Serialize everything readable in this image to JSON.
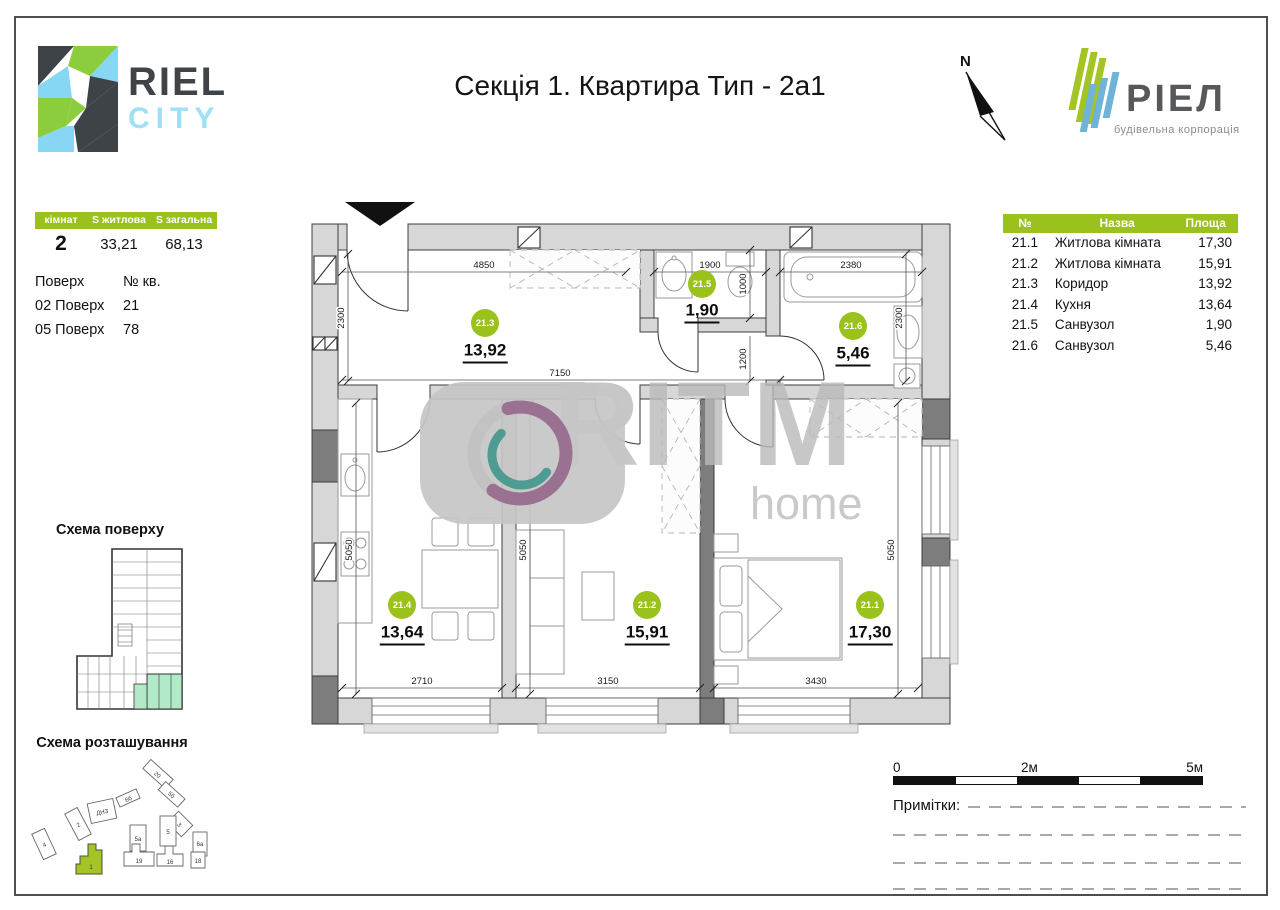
{
  "colors": {
    "accent": "#9bc11d",
    "mint": "#b2e9c8"
  },
  "header": {
    "logo_top": "RIEL",
    "logo_bottom": "CITY",
    "title": "Секція 1. Квартира Тип - 2а1",
    "north_label": "N",
    "brand_name": "РІЕЛ",
    "brand_tagline": "будівельна корпорація"
  },
  "summary": {
    "col_rooms": "кімнат",
    "col_living": "S житлова",
    "col_total": "S загальна",
    "val_rooms": "2",
    "val_living": "33,21",
    "val_total": "68,13",
    "floor_header": "Поверх",
    "apt_header": "№ кв.",
    "floors": [
      {
        "floor": "02 Поверх",
        "apt": "21"
      },
      {
        "floor": "05 Поверх",
        "apt": "78"
      }
    ]
  },
  "rooms_table": {
    "col_num": "№",
    "col_name": "Назва",
    "col_area": "Площа",
    "rows": [
      {
        "num": "21.1",
        "name": "Житлова кімната",
        "area": "17,30"
      },
      {
        "num": "21.2",
        "name": "Житлова кімната",
        "area": "15,91"
      },
      {
        "num": "21.3",
        "name": "Коридор",
        "area": "13,92"
      },
      {
        "num": "21.4",
        "name": "Кухня",
        "area": "13,64"
      },
      {
        "num": "21.5",
        "name": "Санвузол",
        "area": "1,90"
      },
      {
        "num": "21.6",
        "name": "Санвузол",
        "area": "5,46"
      }
    ]
  },
  "plan": {
    "rooms": [
      {
        "id": "21.3",
        "area": "13,92"
      },
      {
        "id": "21.5",
        "area": "1,90"
      },
      {
        "id": "21.6",
        "area": "5,46"
      },
      {
        "id": "21.4",
        "area": "13,64"
      },
      {
        "id": "21.2",
        "area": "15,91"
      },
      {
        "id": "21.1",
        "area": "17,30"
      }
    ],
    "dims": {
      "top_corridor": "4850",
      "top_wc1": "1900",
      "top_wc2": "2380",
      "left_corridor": "2300",
      "corridor_len": "7150",
      "wc1_depth": "1000",
      "hall": "1200",
      "wc2_depth": "2300",
      "kitchen_h": "5050",
      "living_h": "5050",
      "bedroom_h": "5050",
      "kitchen_w": "2710",
      "living_w": "3150",
      "bedroom_w": "3430"
    }
  },
  "schemes": {
    "floor_title": "Схема поверху",
    "site_title": "Схема розташування",
    "site_labels": [
      "20",
      "5б",
      "6б",
      "3",
      "2",
      "ДНЗ",
      "4",
      "5а",
      "5",
      "6а",
      "1",
      "19",
      "16",
      "18"
    ]
  },
  "footer": {
    "scale_0": "0",
    "scale_2": "2м",
    "scale_5": "5м",
    "notes_label": "Примітки:"
  },
  "watermark": {
    "brand": "RITM",
    "sub": "home"
  }
}
